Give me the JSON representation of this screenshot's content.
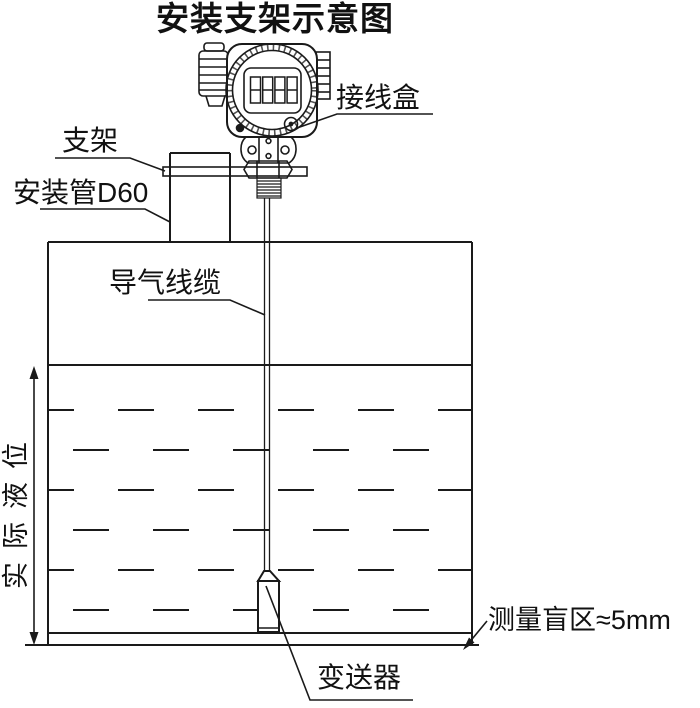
{
  "title": "安装支架示意图",
  "labels": {
    "junction_box": "接线盒",
    "bracket": "支架",
    "mounting_pipe": "安装管D60",
    "air_cable": "导气线缆",
    "actual_level": "实际液位",
    "blind_zone": "测量盲区≈5mm",
    "transmitter": "变送器"
  },
  "display_reading": "8888",
  "colors": {
    "line": "#1a1a1a",
    "background": "#ffffff"
  }
}
